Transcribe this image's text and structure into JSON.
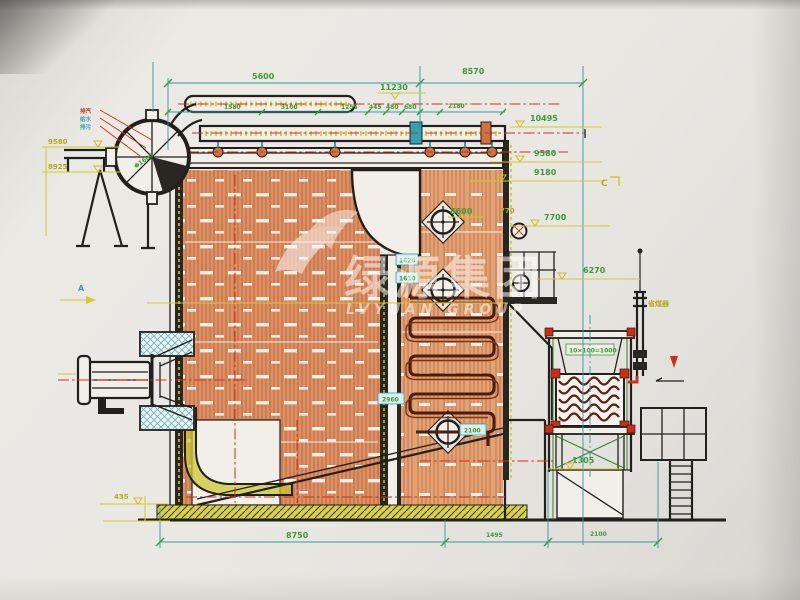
{
  "watermark": {
    "cn": "绿源集团",
    "en": "LVYUAN GROUP"
  },
  "dims": {
    "top5600": "5600",
    "top8570": "8570",
    "row": {
      "r1": "1580",
      "r2": "3100",
      "r3": "1255",
      "r4": "445",
      "r5": "480",
      "r6": "680",
      "r7": "2180"
    },
    "bottom": {
      "b1": "8750",
      "b2": "1495",
      "b3": "2100"
    }
  },
  "elevations": {
    "lvl11230": "11230",
    "e10495": "10495",
    "e9580r": "9580",
    "e9180": "9180",
    "e7700": "7700",
    "e770": "770",
    "e6270": "6270",
    "e1305": "1305",
    "e9580l": "9580",
    "e8925": "8925",
    "e435": "435"
  },
  "internal": {
    "i8600": "8600",
    "i1620": "1620",
    "i1610": "1610",
    "i2960": "2960",
    "i2100": "2100",
    "iecon": "10×100=1000",
    "idrum": "Φ1600"
  },
  "markers": {
    "a": "A",
    "c": "C"
  },
  "labels": {
    "economizer": "省煤器",
    "conn1": "排汽",
    "conn2": "给水",
    "conn3": "排污"
  }
}
